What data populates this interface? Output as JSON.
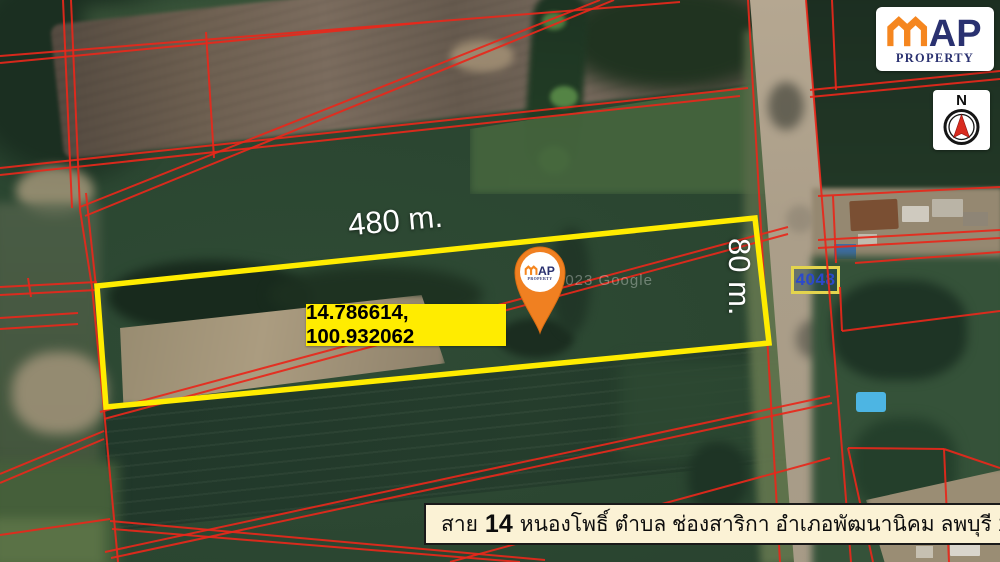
{
  "brand": {
    "name_top": "MAP",
    "name_bottom": "PROPERTY"
  },
  "compass": {
    "north_label": "N"
  },
  "labels": {
    "width": "480 m.",
    "depth": "80 m.",
    "coordinates": "14.786614, 100.932062"
  },
  "road_sign": {
    "route_number": "4048"
  },
  "map_credit": {
    "text": "2023 Google"
  },
  "caption": {
    "road_prefix": "สาย",
    "road_number": "14",
    "address": "หนองโพธิ์ ตำบล ช่องสาริกา อำเภอพัฒนานิคม ลพบุรี 15220"
  },
  "colors": {
    "boundary_yellow": "#ffec00",
    "parcel_line_red": "#e8281b",
    "brand_orange": "#f5861f",
    "brand_navy": "#2a3170",
    "pin_orange": "#f08021",
    "compass_red": "#d92b1f",
    "caption_bg": "#fbf2d5",
    "sign_border_yellow": "#e3d44e",
    "sign_text_blue": "#2b49cc"
  }
}
